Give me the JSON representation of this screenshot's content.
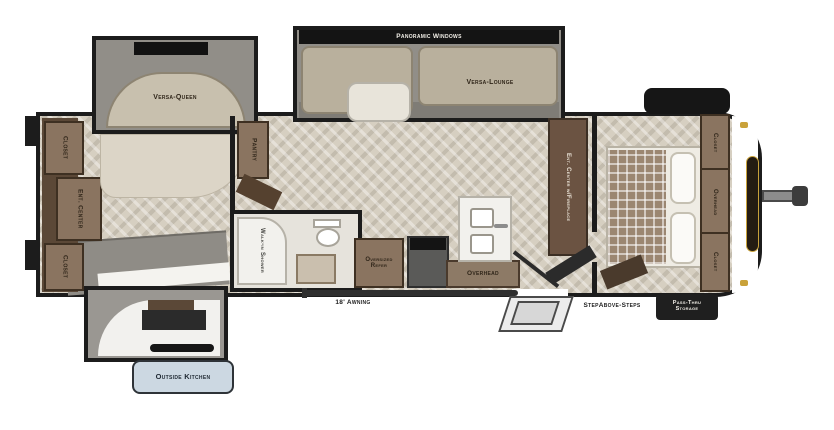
{
  "floorplan": {
    "labels": {
      "versa_queen": "Versa-Queen",
      "panoramic_windows": "Panoramic Windows",
      "versa_lounge": "Versa-Lounge",
      "closet": "Closet",
      "ent_center": "Ent. Center",
      "pantry": "Pantry",
      "walk_in_shower": "Walk-in Shower",
      "oversized_refer": "Oversized Refer",
      "overhead": "Overhead",
      "ent_center_fireplace": "Ent. Center w/Fireplace",
      "awning": "18' Awning",
      "steps": "StepAbove-Steps",
      "pass_thru_line1": "Pass-Thru",
      "pass_thru_line2": "Storage",
      "outside_kitchen": "Outside Kitchen"
    },
    "colors": {
      "wall": "#1c1c1c",
      "floor_base": "#d6cfc1",
      "slide_carpet": "#918e88",
      "cabinet_wood": "#8a7460",
      "cabinet_wood_dark": "#5b4837",
      "sofa": "#b9b09d",
      "badge_fill": "#ccd8e2",
      "badge_border": "#2e3338",
      "marker_light_gold": "#c9a23a",
      "label_text": "#2f2519"
    }
  }
}
